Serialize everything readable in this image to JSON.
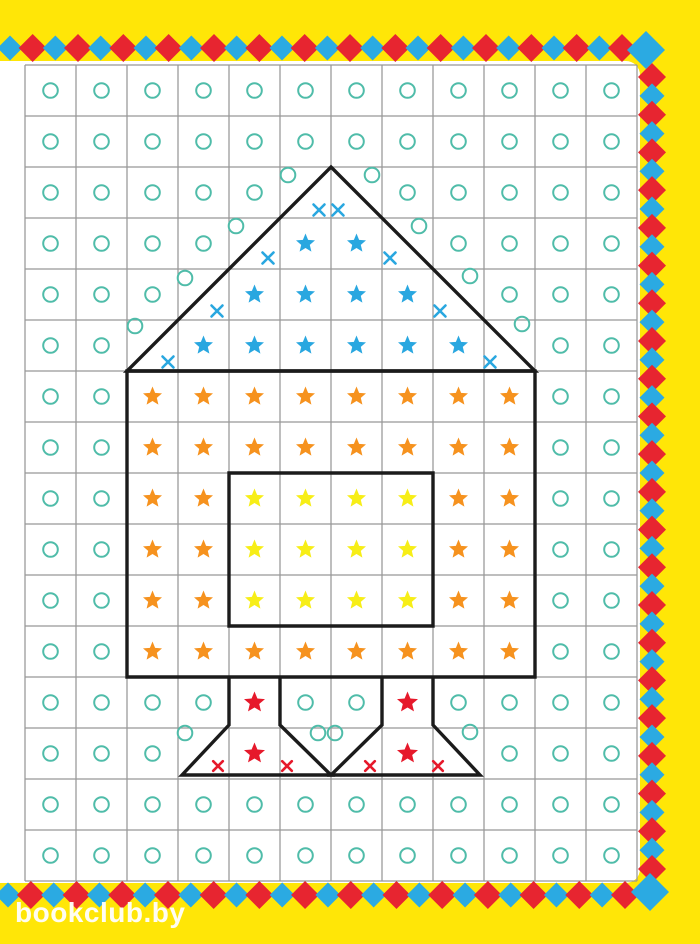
{
  "page": {
    "title": "rocket-grid-worksheet",
    "watermark": "bookclub.by",
    "background": "#FFE607",
    "paper": "#FFFFFF"
  },
  "palette": {
    "teal_circle": "#4FBCA9",
    "blue_star": "#29A7E0",
    "orange_star": "#F6921E",
    "yellow_star": "#F7EE17",
    "red_symbol": "#E6192B",
    "diamond_red": "#E72530",
    "diamond_blue": "#2BAAE2",
    "outline_black": "#1B1B1B",
    "grid_line": "#979797"
  },
  "grid": {
    "x": 25,
    "y": 65,
    "cell": 51,
    "cols": 12,
    "rows": 16
  },
  "cells": {
    "legend": {
      "o": "teal-circle",
      "B": "blue-star",
      "O": "orange-star",
      "Y": "yellow-star",
      "R": "red-star",
      ".": "empty"
    },
    "rows": [
      "oooooooooooo",
      "oooooooooooo",
      "ooooo..ooooo",
      "oooo.BB.oooo",
      "ooo.BBBB.ooo",
      "oo.BBBBBB.oo",
      "ooOOOOOOOOoo",
      "ooOOOOOOOOoo",
      "ooOOYYYYOOoo",
      "ooOOYYYYOOoo",
      "ooOOYYYYOOoo",
      "ooOOOOOOOOoo",
      "ooooRooRoooo",
      "ooo.R..R.ooo",
      "oooooooooooo",
      "oooooooooooo"
    ]
  },
  "loose_symbols": {
    "teal_circles": [
      [
        288,
        175
      ],
      [
        372,
        175
      ],
      [
        236,
        226
      ],
      [
        419,
        226
      ],
      [
        185,
        278
      ],
      [
        470,
        276
      ],
      [
        135,
        326
      ],
      [
        522,
        324
      ],
      [
        185,
        733
      ],
      [
        318,
        733
      ],
      [
        335,
        733
      ],
      [
        470,
        732
      ]
    ],
    "blue_x": [
      [
        319,
        210
      ],
      [
        338,
        210
      ],
      [
        268,
        258
      ],
      [
        390,
        258
      ],
      [
        217,
        311
      ],
      [
        440,
        311
      ],
      [
        168,
        362
      ],
      [
        490,
        362
      ]
    ],
    "red_x": [
      [
        218,
        766
      ],
      [
        287,
        766
      ],
      [
        370,
        766
      ],
      [
        438,
        766
      ]
    ]
  },
  "rocket_outline": {
    "stroke_width": 3.4,
    "paths": [
      "M331,167 L535,371 L127,371 Z",
      "M127,371 H535 V677 H127 Z",
      "M229,473 H433 V626 H229 Z",
      "M229,677 V725 L182,775 H331 L280,725 V677",
      "M382,677 V725 L331,775 H480 L433,725 V677"
    ]
  },
  "border": {
    "top": {
      "orient": "h",
      "pos": 48,
      "from": 10,
      "to": 622,
      "count": 28,
      "first": "blue"
    },
    "bottom": {
      "orient": "h",
      "pos": 895,
      "from": 8,
      "to": 625,
      "count": 28,
      "first": "blue"
    },
    "right": {
      "orient": "v",
      "pos": 652,
      "from": 77,
      "to": 869,
      "count": 43,
      "first": "red"
    },
    "corner_diamonds": [
      {
        "x": 646,
        "y": 50
      },
      {
        "x": 650,
        "y": 892
      }
    ],
    "small_blue_r": 12.5,
    "small_red_r": 14,
    "corner_r": 19
  },
  "symbol_sizes": {
    "circle_r": 7.3,
    "circle_stroke": 2,
    "star_r": 10,
    "red_star_r": 11,
    "blue_x_arm": 5.5,
    "red_x_arm": 4.8,
    "x_stroke": 2.6
  },
  "paper_rect": {
    "x": -16,
    "y": 61,
    "w": 656,
    "h": 822,
    "rx": 14
  }
}
